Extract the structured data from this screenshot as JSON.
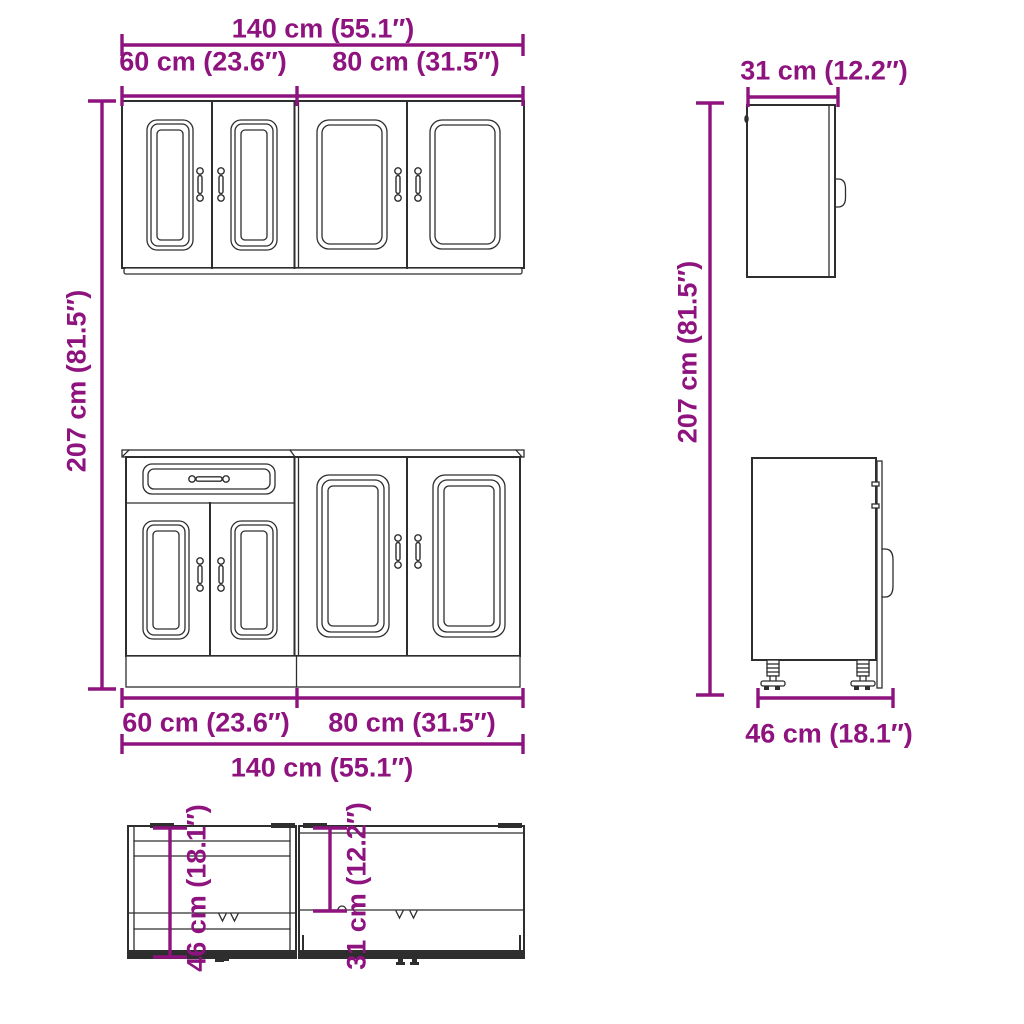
{
  "colors": {
    "dimension": "#8E137F",
    "line": "#2e2e2e",
    "background": "#ffffff"
  },
  "labels": {
    "total_width": "140 cm (55.1″)",
    "left_unit_width": "60 cm (23.6″)",
    "right_unit_width": "80 cm (31.5″)",
    "overall_height": "207 cm (81.5″)",
    "wall_cabinet_depth": "31 cm (12.2″)",
    "base_cabinet_depth": "46 cm (18.1″)"
  }
}
